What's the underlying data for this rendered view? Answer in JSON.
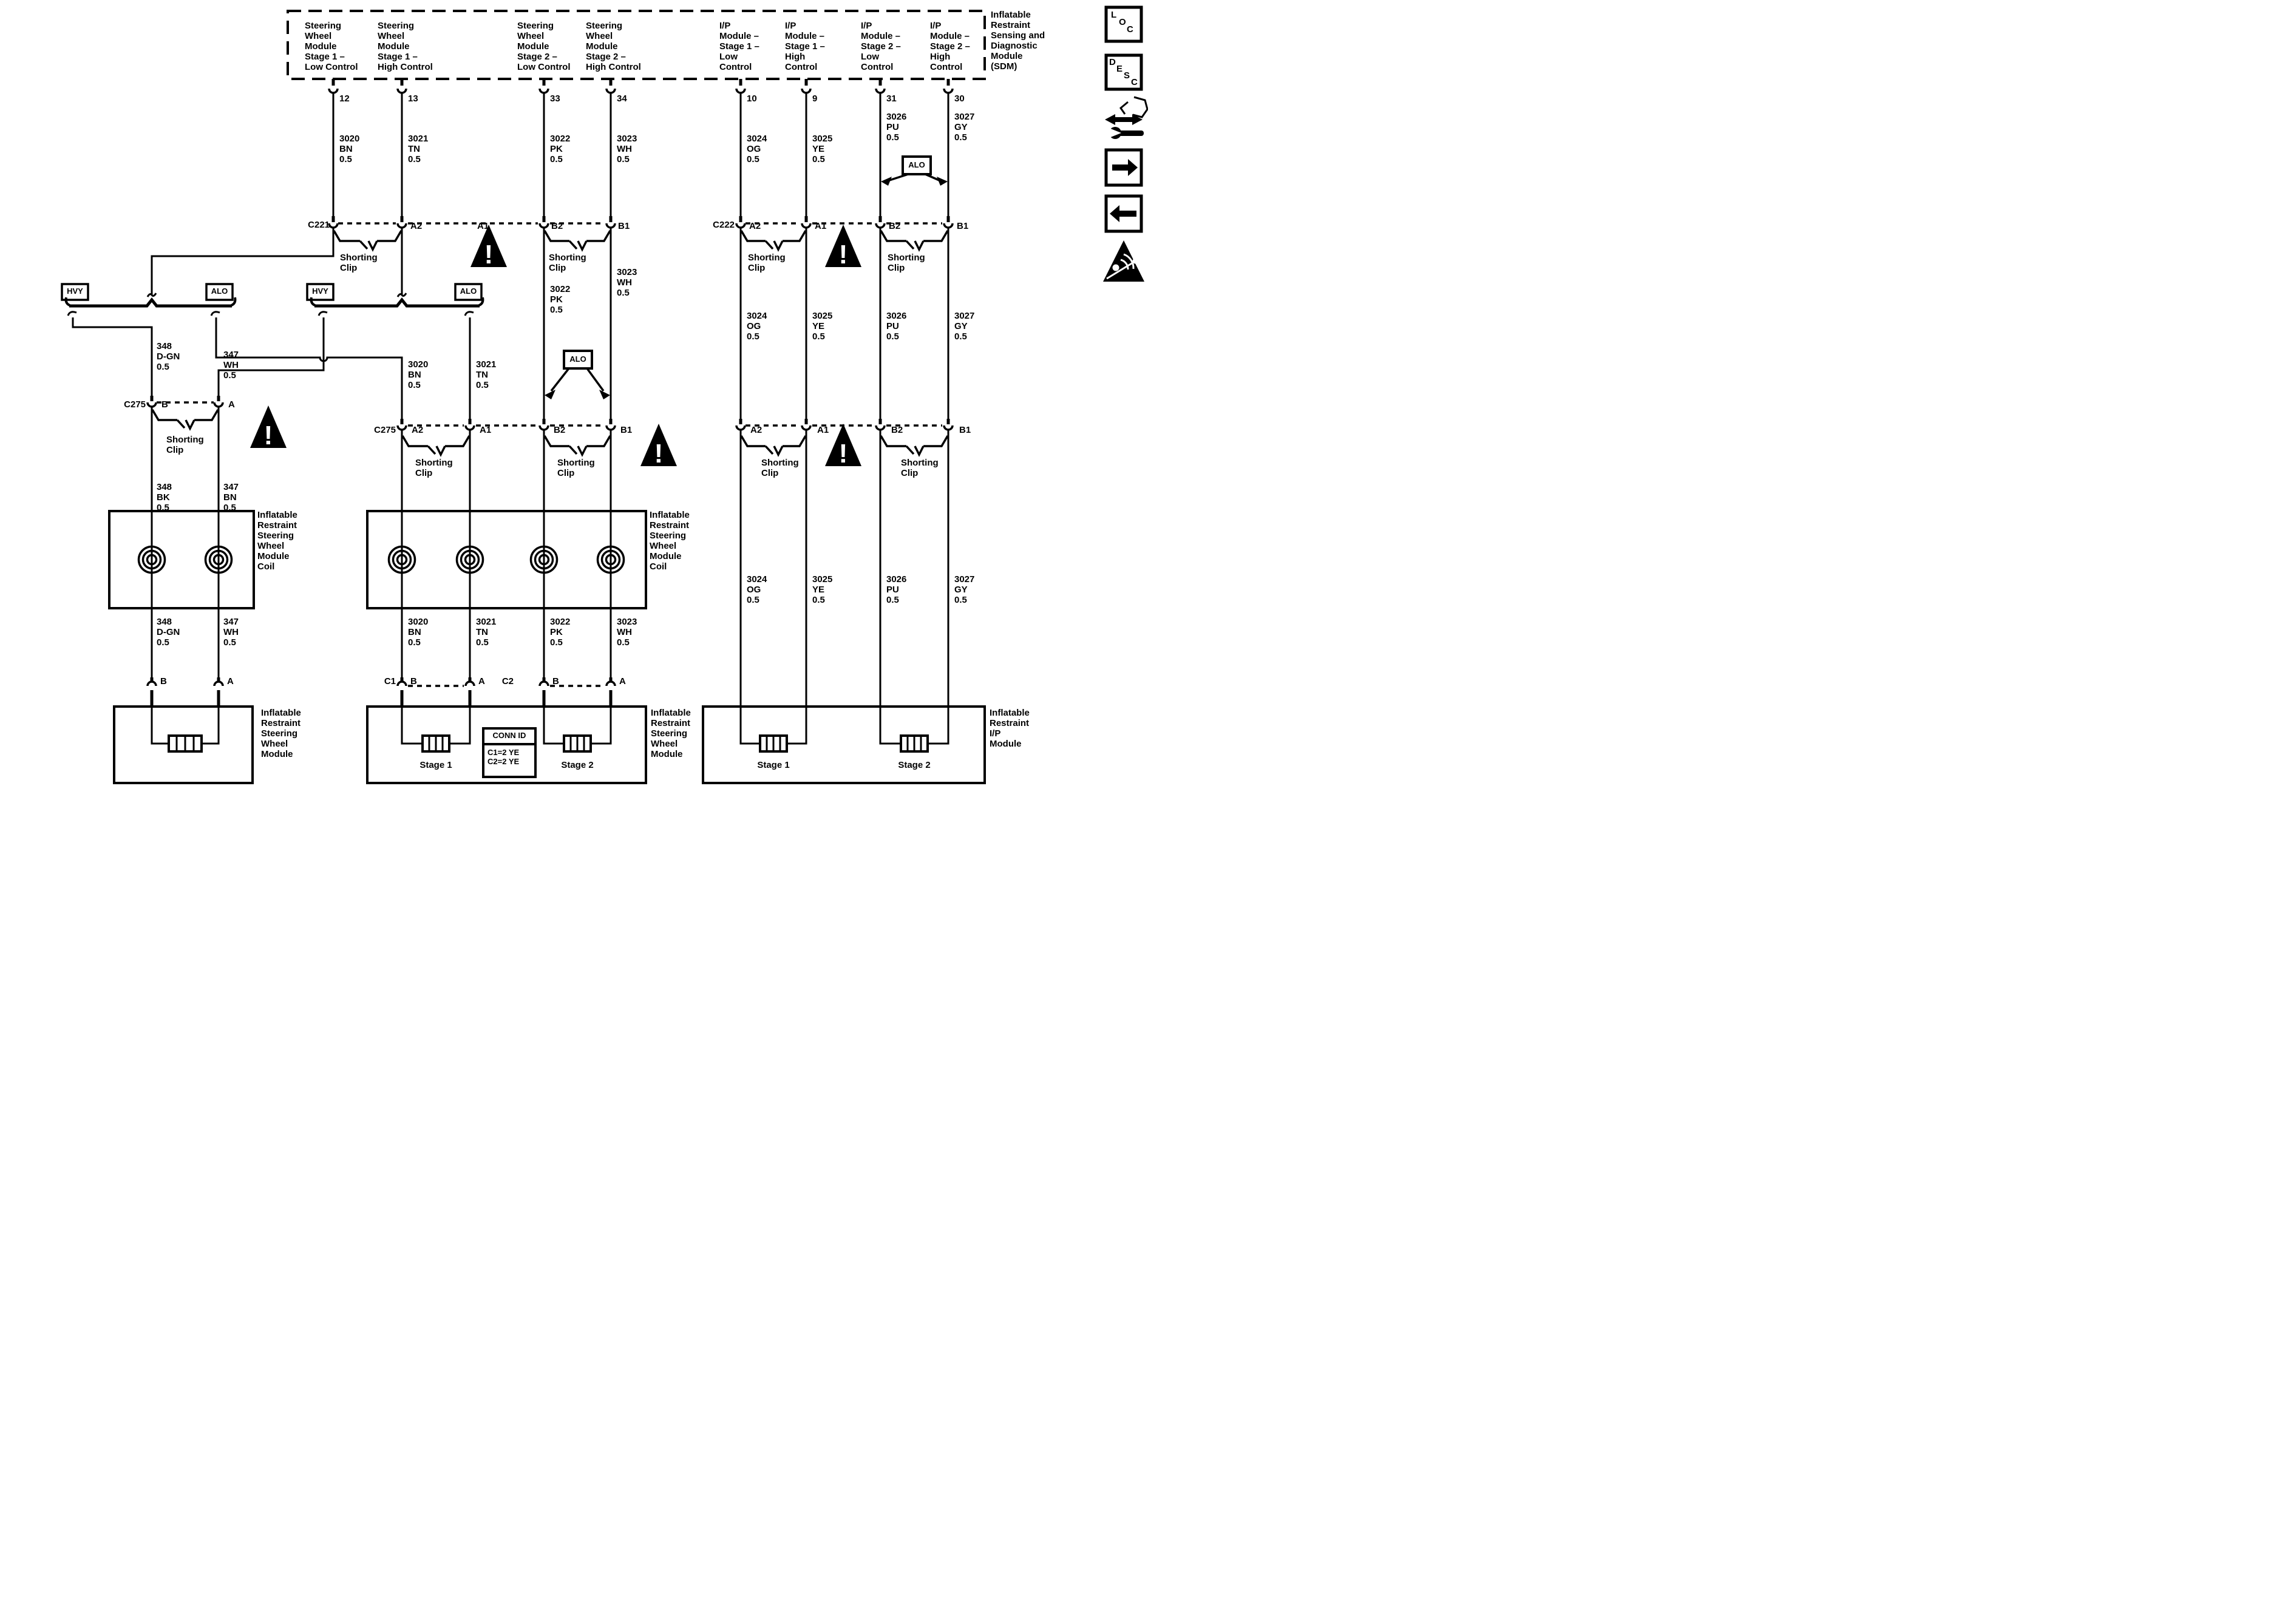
{
  "colors": {
    "ink": "#000000",
    "paper": "#ffffff"
  },
  "top_modules": [
    "Steering\nWheel\nModule\nStage 1 –\nLow Control",
    "Steering\nWheel\nModule\nStage 1 –\nHigh Control",
    "Steering\nWheel\nModule\nStage 2 –\nLow Control",
    "Steering\nWheel\nModule\nStage 2 –\nHigh Control",
    "I/P\nModule –\nStage 1 –\nLow\nControl",
    "I/P\nModule –\nStage 1 –\nHigh\nControl",
    "I/P\nModule –\nStage 2 –\nLow\nControl",
    "I/P\nModule –\nStage 2 –\nHigh\nControl"
  ],
  "sdm_label": "Inflatable\nRestraint\nSensing and\nDiagnostic\nModule\n(SDM)",
  "pins": [
    "12",
    "13",
    "33",
    "34",
    "10",
    "9",
    "31",
    "30"
  ],
  "wires": {
    "w3020": "3020\nBN\n0.5",
    "w3021": "3021\nTN\n0.5",
    "w3022": "3022\nPK\n0.5",
    "w3023": "3023\nWH\n0.5",
    "w3024": "3024\nOG\n0.5",
    "w3025": "3025\nYE\n0.5",
    "w3026": "3026\nPU\n0.5",
    "w3027": "3027\nGY\n0.5",
    "w348dgn": "348\nD-GN\n0.5",
    "w347wh": "347\nWH\n0.5",
    "w348bk": "348\nBK\n0.5",
    "w347bn": "347\nBN\n0.5"
  },
  "connectors": {
    "c221": "C221",
    "c222": "C222",
    "c275": "C275",
    "c1": "C1",
    "c2": "C2"
  },
  "row_pins": {
    "a2": "A2",
    "a1": "A1",
    "b2": "B2",
    "b1": "B1",
    "a": "A",
    "b": "B"
  },
  "tags": {
    "hvy": "HVY",
    "alo": "ALO"
  },
  "labels": {
    "shorting_clip": "Shorting\nClip"
  },
  "modules": {
    "coil": "Inflatable\nRestraint\nSteering\nWheel\nModule\nCoil",
    "swm": "Inflatable\nRestraint\nSteering\nWheel\nModule",
    "ipm": "Inflatable\nRestraint\nI/P\nModule",
    "stage1": "Stage 1",
    "stage2": "Stage 2"
  },
  "conn_id": {
    "header": "CONN ID",
    "rows": "C1=2 YE\nC2=2 YE"
  },
  "sidebar": {
    "loc": [
      "L",
      "O",
      "C"
    ],
    "desc": [
      "D",
      "E",
      "S",
      "C"
    ]
  }
}
